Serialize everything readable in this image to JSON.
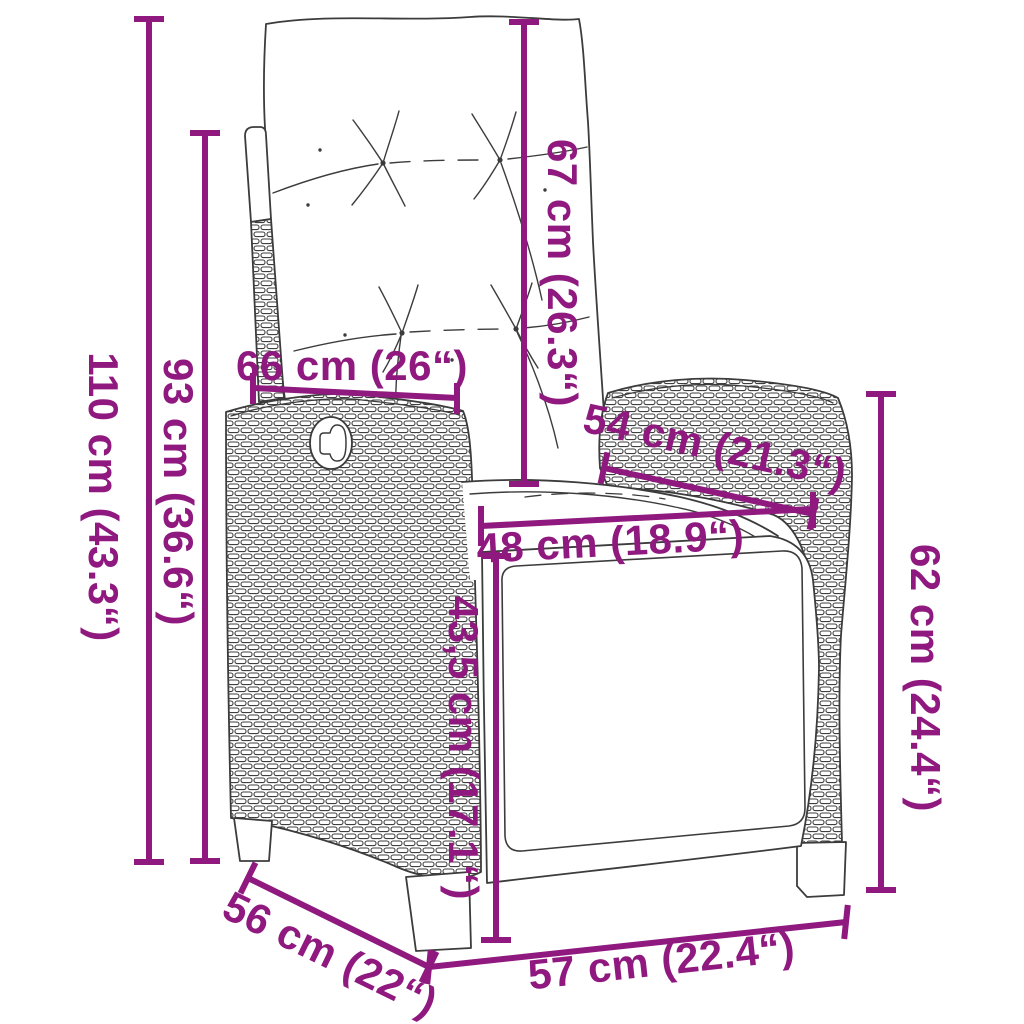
{
  "diagram": {
    "accent_color": "#8F197F",
    "outline_color": "#3C3C3C",
    "background_color": "#FFFFFF",
    "dimensions": [
      {
        "id": "total-height",
        "label": "110 cm (43.3“)"
      },
      {
        "id": "backrest-height",
        "label": "93 cm (36.6“)"
      },
      {
        "id": "back-cushion-height",
        "label": "67 cm (26.3“)"
      },
      {
        "id": "backrest-width",
        "label": "66 cm (26“)"
      },
      {
        "id": "armrest-top-depth",
        "label": "54 cm (21.3“)"
      },
      {
        "id": "seat-width",
        "label": "48 cm (18.9“)"
      },
      {
        "id": "footrest-height",
        "label": "43,5 cm (17.1“)"
      },
      {
        "id": "armrest-height",
        "label": "62 cm (24.4“)"
      },
      {
        "id": "seat-depth",
        "label": "56 cm (22“)"
      },
      {
        "id": "base-width",
        "label": "57 cm (22.4“)"
      }
    ]
  }
}
